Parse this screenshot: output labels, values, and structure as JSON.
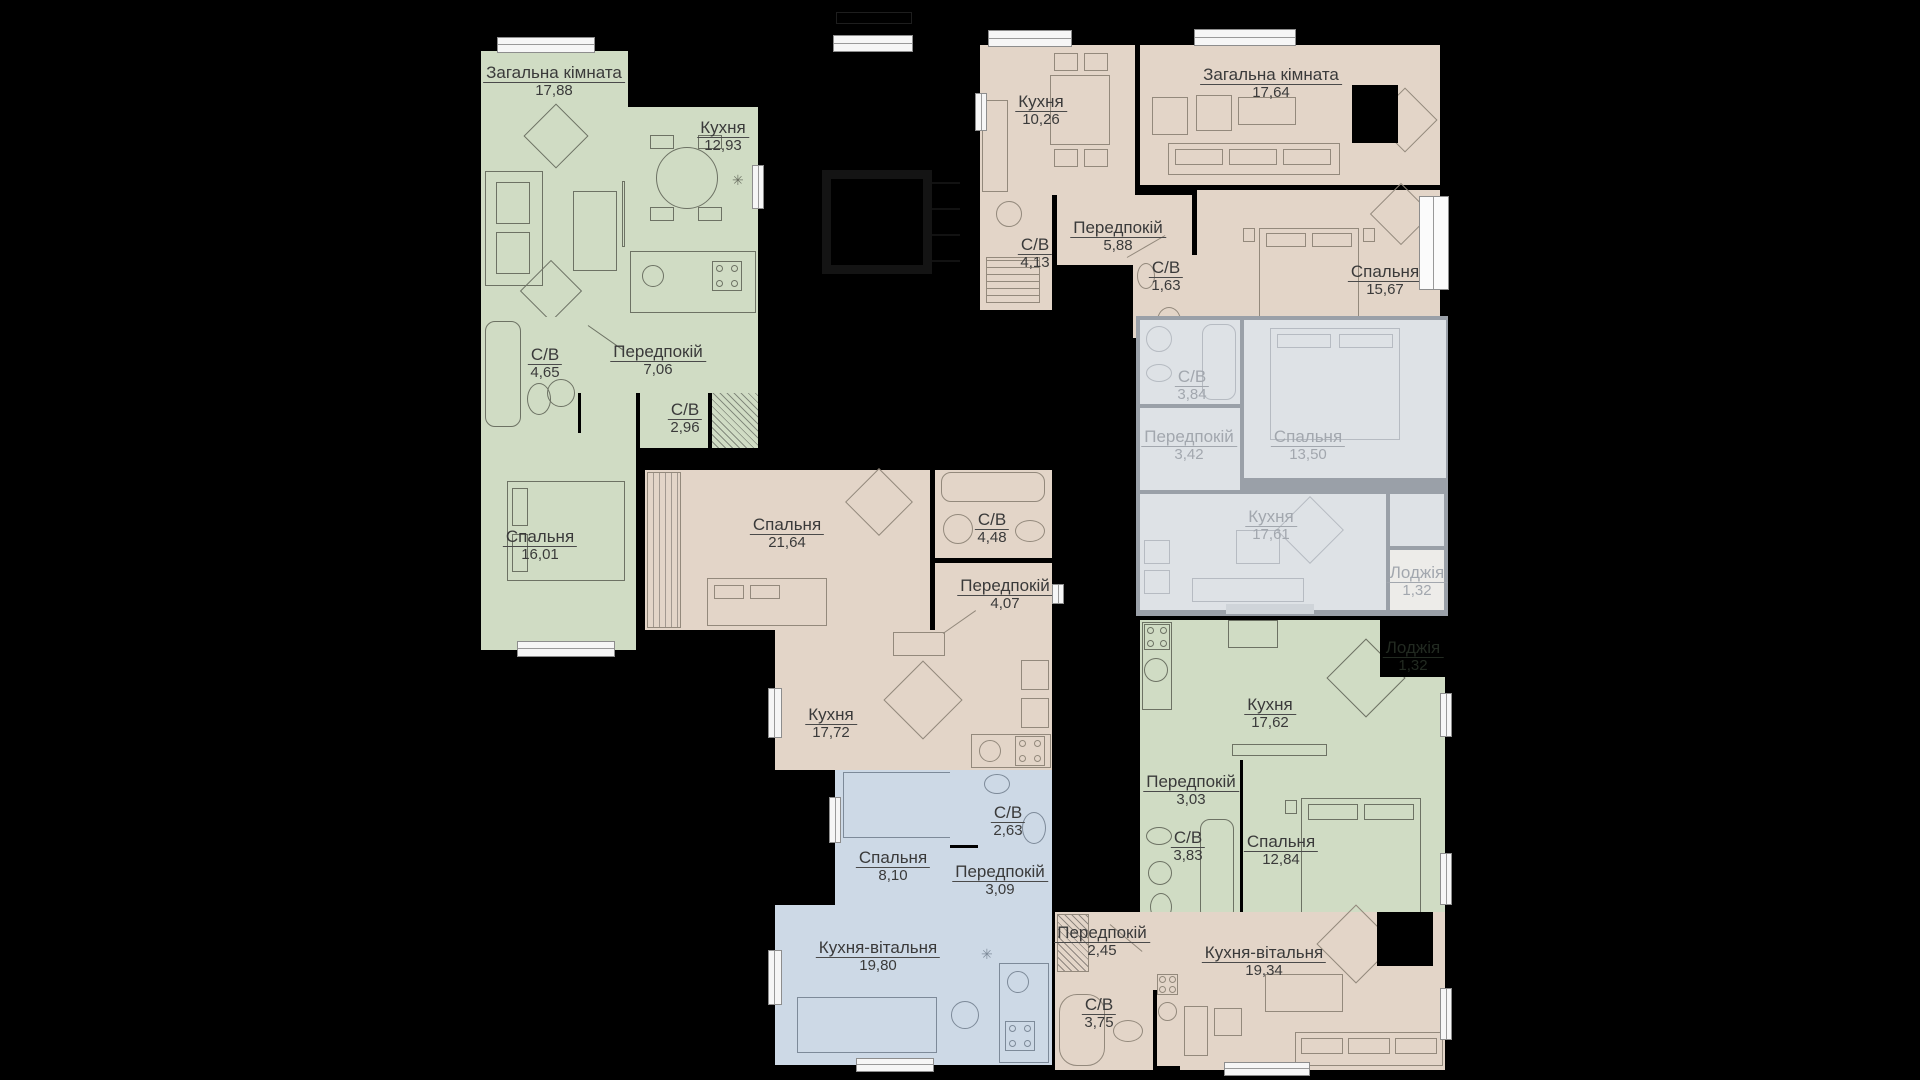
{
  "colors": {
    "background": "#000000",
    "apartment_green": "#d0dcc4",
    "apartment_tan": "#e3d5c8",
    "apartment_blue": "#cdd9e6",
    "apartment_gray_fill": "#dee2e6",
    "apartment_gray_wall": "#9aa0a8",
    "label_text": "#3a3a3a",
    "gray_label_text": "#a2a7ae",
    "window": "#f6f6f6"
  },
  "apartments": [
    {
      "id": "apt-top-left",
      "scheme": "green",
      "rooms": [
        {
          "name": "Загальна кімната",
          "area": "17,88"
        },
        {
          "name": "Кухня",
          "area": "12,93"
        },
        {
          "name": "С/В",
          "area": "4,65"
        },
        {
          "name": "Передпокій",
          "area": "7,06"
        },
        {
          "name": "С/В",
          "area": "2,96"
        },
        {
          "name": "Спальня",
          "area": "16,01"
        }
      ]
    },
    {
      "id": "apt-center",
      "scheme": "tan",
      "rooms": [
        {
          "name": "Спальня",
          "area": "21,64"
        },
        {
          "name": "С/В",
          "area": "4,48"
        },
        {
          "name": "Передпокій",
          "area": "4,07"
        },
        {
          "name": "Кухня",
          "area": "17,72"
        }
      ]
    },
    {
      "id": "apt-bottom-center",
      "scheme": "blue",
      "rooms": [
        {
          "name": "Спальня",
          "area": "8,10"
        },
        {
          "name": "С/В",
          "area": "2,63"
        },
        {
          "name": "Передпокій",
          "area": "3,09"
        },
        {
          "name": "Кухня-вітальня",
          "area": "19,80"
        }
      ]
    },
    {
      "id": "apt-top-right",
      "scheme": "tan",
      "rooms": [
        {
          "name": "Кухня",
          "area": "10,26"
        },
        {
          "name": "Загальна кімната",
          "area": "17,64"
        },
        {
          "name": "С/В",
          "area": "4,13"
        },
        {
          "name": "Передпокій",
          "area": "5,88"
        },
        {
          "name": "С/В",
          "area": "1,63"
        },
        {
          "name": "Спальня",
          "area": "15,67"
        }
      ]
    },
    {
      "id": "apt-right-gray",
      "scheme": "gray",
      "rooms": [
        {
          "name": "С/В",
          "area": "3,84"
        },
        {
          "name": "Передпокій",
          "area": "3,42"
        },
        {
          "name": "Спальня",
          "area": "13,50"
        },
        {
          "name": "Кухня",
          "area": "17,61"
        },
        {
          "name": "Лоджія",
          "area": "1,32"
        }
      ]
    },
    {
      "id": "apt-right-green",
      "scheme": "green",
      "rooms": [
        {
          "name": "Кухня",
          "area": "17,62"
        },
        {
          "name": "Передпокій",
          "area": "3,03"
        },
        {
          "name": "С/В",
          "area": "3,83"
        },
        {
          "name": "Спальня",
          "area": "12,84"
        }
      ]
    },
    {
      "id": "apt-bottom-right",
      "scheme": "tan",
      "rooms": [
        {
          "name": "Передпокій",
          "area": "2,45"
        },
        {
          "name": "С/В",
          "area": "3,75"
        },
        {
          "name": "Кухня-вітальня",
          "area": "19,34"
        }
      ]
    }
  ],
  "misc": {
    "dark_loggia": {
      "name": "Лоджія",
      "area": "1,32"
    }
  }
}
